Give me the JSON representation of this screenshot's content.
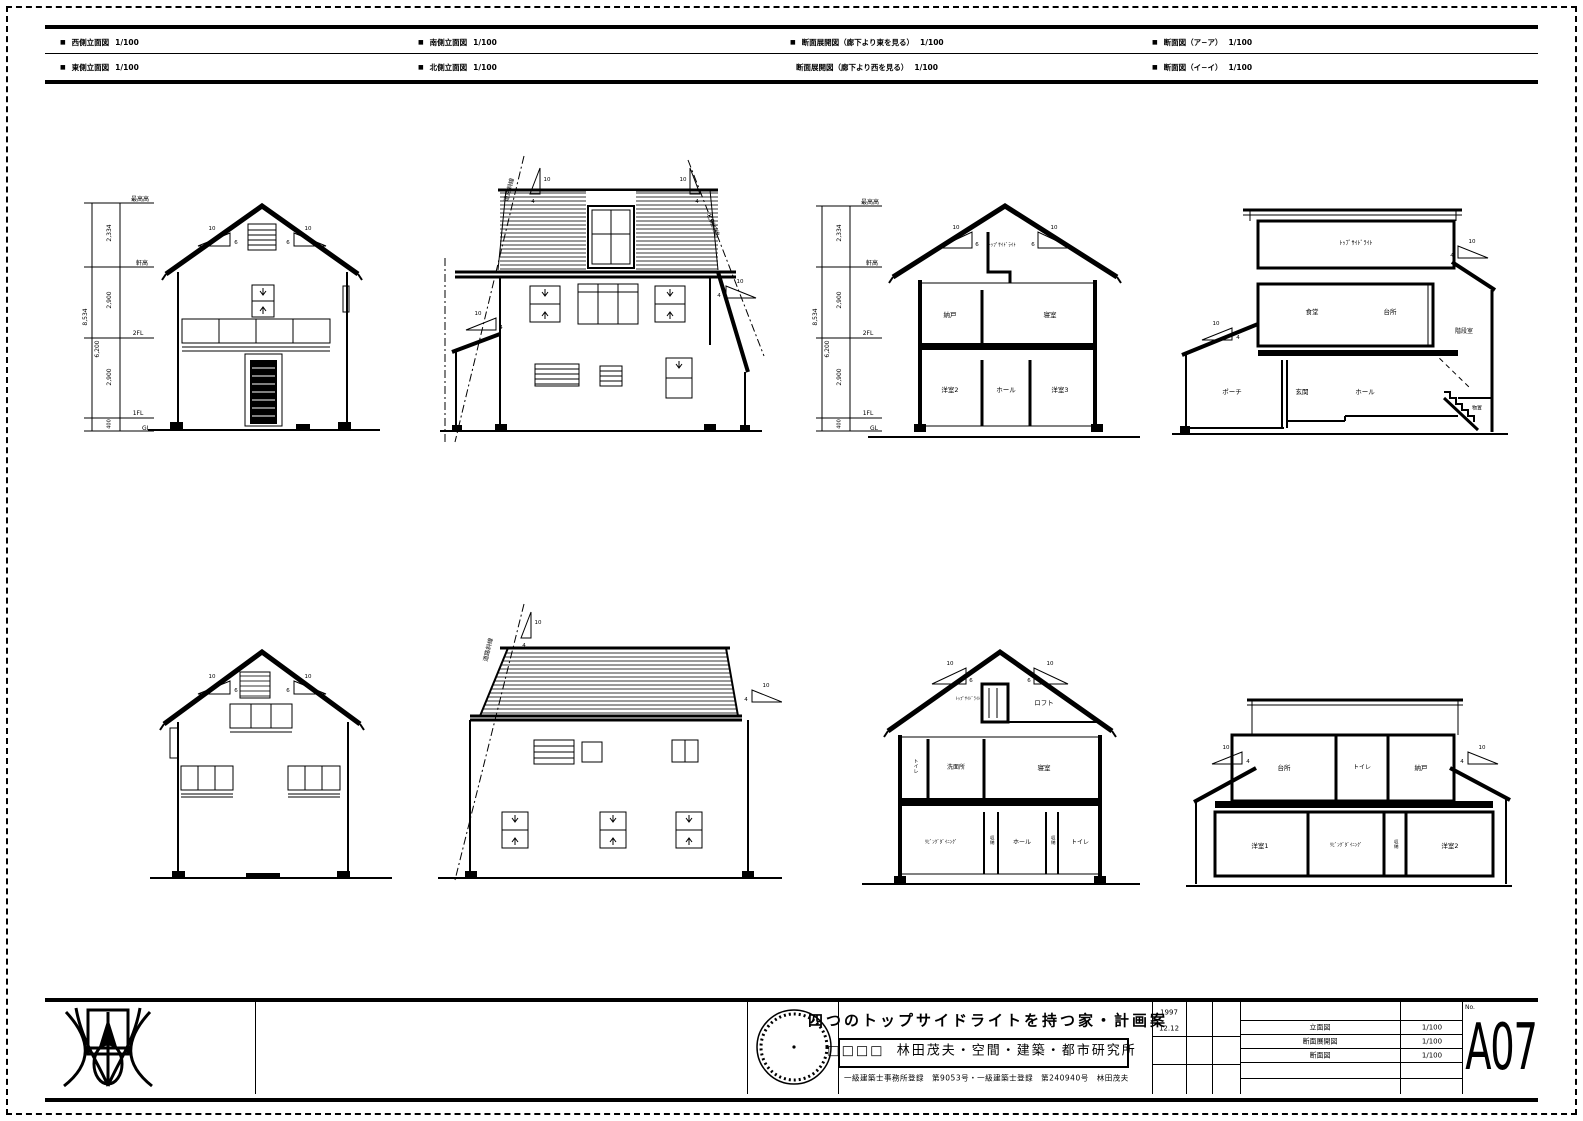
{
  "page": {
    "bullet": "■"
  },
  "header": {
    "rows": [
      {
        "cells": [
          {
            "name": "西側立面図",
            "scale": "1/100"
          },
          {
            "name": "南側立面図",
            "scale": "1/100"
          },
          {
            "name": "断面展開図（廊下より東を見る）",
            "scale": "1/100"
          },
          {
            "name": "断面図（ア−ア）",
            "scale": "1/100"
          }
        ]
      },
      {
        "cells": [
          {
            "name": "東側立面図",
            "scale": "1/100"
          },
          {
            "name": "北側立面図",
            "scale": "1/100"
          },
          {
            "name": "断面展開図（廊下より西を見る）",
            "scale": "1/100"
          },
          {
            "name": "断面図（イ−イ）",
            "scale": "1/100"
          }
        ]
      }
    ]
  },
  "dims": {
    "levels": [
      "最高高",
      "軒高",
      "2FL",
      "1FL",
      "GL"
    ],
    "segments": [
      "2,334",
      "2,900",
      "2,900",
      "400"
    ],
    "total": "8,534",
    "sub": "6,200"
  },
  "slopes": {
    "run": "10",
    "gable": "6",
    "shed": "4"
  },
  "setback": {
    "road": "道路斜線",
    "north": "北側斜線"
  },
  "rooms": {
    "sec_a": {
      "attic": "ﾄｯﾌﾟｻｲﾄﾞﾗｲﾄ",
      "f2": [
        "納戸",
        "寝室"
      ],
      "f1": [
        "洋室2",
        "ホール",
        "洋室3"
      ]
    },
    "dev_e": {
      "attic": "ﾄｯﾌﾟｻｲﾄﾞﾗｲﾄ",
      "f2": [
        "食堂",
        "台所"
      ],
      "stair": "階段室",
      "f1": [
        "ポーチ",
        "玄関",
        "ホール",
        "物置"
      ]
    },
    "sec_b": {
      "attic": "ﾄｯﾌﾟｻｲﾄﾞﾗｲﾄ",
      "loft": "ロフト",
      "f2": [
        "トイレ",
        "洗面所",
        "寝室"
      ],
      "f1": [
        "ﾘﾋﾞﾝｸﾞﾀﾞｲﾆﾝｸﾞ",
        "収納",
        "ホール",
        "収納",
        "トイレ"
      ]
    },
    "dev_w": {
      "f2": [
        "台所",
        "トイレ",
        "納戸"
      ],
      "f1": [
        "洋室1",
        "ﾘﾋﾞﾝｸﾞﾀﾞｲﾆﾝｸﾞ",
        "収納",
        "洋室2"
      ]
    }
  },
  "title_block": {
    "title": "四つのトップサイドライトを持つ家・計画案",
    "firm_prefix": "□□□□",
    "firm": "林田茂夫・空間・建築・都市研究所",
    "license": "一級建築士事務所登録　第9053号・一級建築士登録　第240940号　林田茂夫",
    "date_year": "1997",
    "date_md": "12.12",
    "index": [
      {
        "name": "立面図",
        "scale": "1/100"
      },
      {
        "name": "断面展開図",
        "scale": "1/100"
      },
      {
        "name": "断面図",
        "scale": "1/100"
      }
    ],
    "sheet_label": "No.",
    "sheet_no": "A07"
  }
}
